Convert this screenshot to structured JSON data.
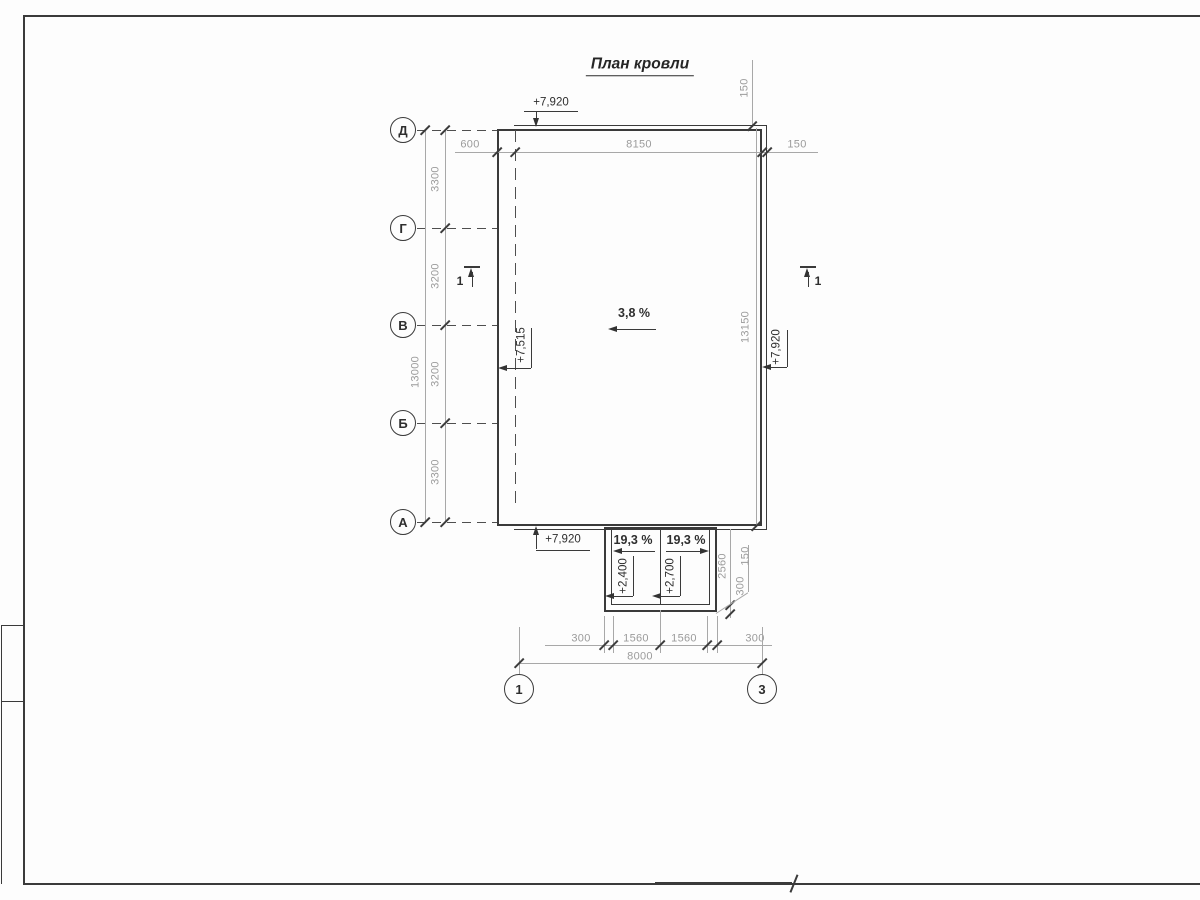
{
  "title": "План кровли",
  "grid": {
    "row_axes": [
      "Д",
      "Г",
      "В",
      "Б",
      "А"
    ],
    "col_axes": [
      "1",
      "3"
    ]
  },
  "sections": {
    "left": "1",
    "right": "1"
  },
  "slopes": {
    "main": "3,8 %",
    "canopy_left": "19,3 %",
    "canopy_right": "19,3 %"
  },
  "elevations": {
    "roof_top": "+7,920",
    "roof_left": "+7,515",
    "roof_right": "+7,920",
    "roof_bottom": "+7,920",
    "canopy_left": "+2,400",
    "canopy_right": "+2,700"
  },
  "dims": {
    "top": {
      "overhang": "600",
      "roof_width": "8150",
      "parapet": "150",
      "parapet_v": "150"
    },
    "left": {
      "spans": [
        "3300",
        "3200",
        "3200",
        "3300"
      ],
      "total": "13000"
    },
    "right": {
      "roof_length": "13150"
    },
    "canopy": {
      "depth": "2560",
      "parapet": "150",
      "offset": "300"
    },
    "bottom": {
      "spans": [
        "300",
        "1560",
        "1560",
        "300"
      ],
      "total": "8000"
    }
  },
  "colors": {
    "line": "#3a3a3a",
    "dim_text": "#9b9b9b",
    "text": "#2e2e2e"
  }
}
